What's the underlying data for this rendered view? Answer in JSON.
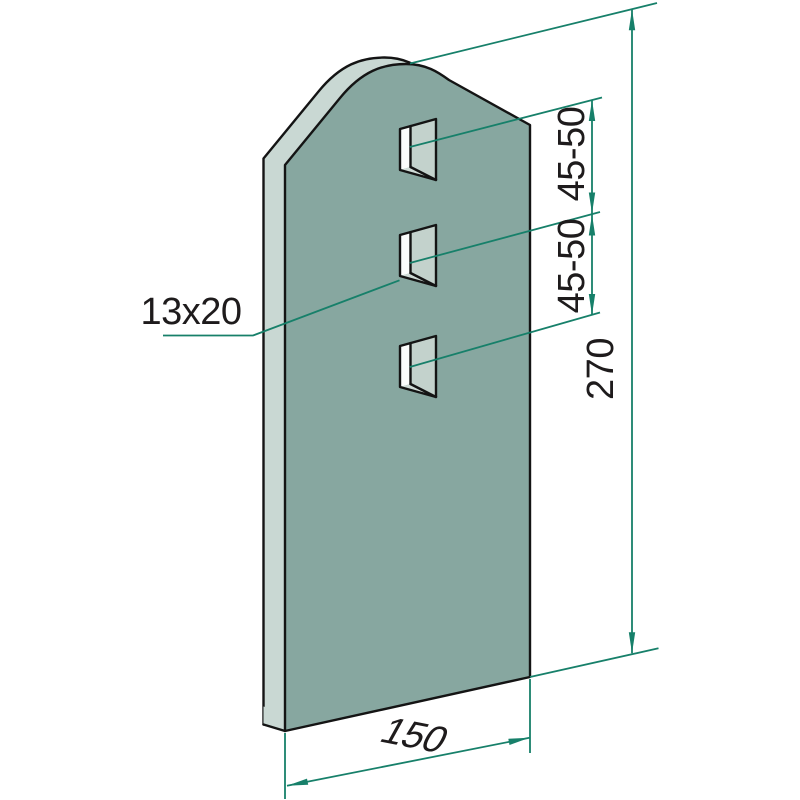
{
  "labels": {
    "hole_size": "13x20",
    "hole_spacing_upper": "45-50",
    "hole_spacing_lower": "45-50",
    "plate_height": "270",
    "plate_width": "150"
  },
  "colors": {
    "background": "#FFFFFF",
    "face": "#87A7A0",
    "edge_band": "#C9D8D3",
    "hole_inner_wall": "#C3D2CC",
    "hole_bottom_wall": "#CFDBD6",
    "hole_through": "#FBFDFC",
    "outline": "#141414",
    "dimension": "#17806A",
    "text": "#1E1B1C"
  }
}
